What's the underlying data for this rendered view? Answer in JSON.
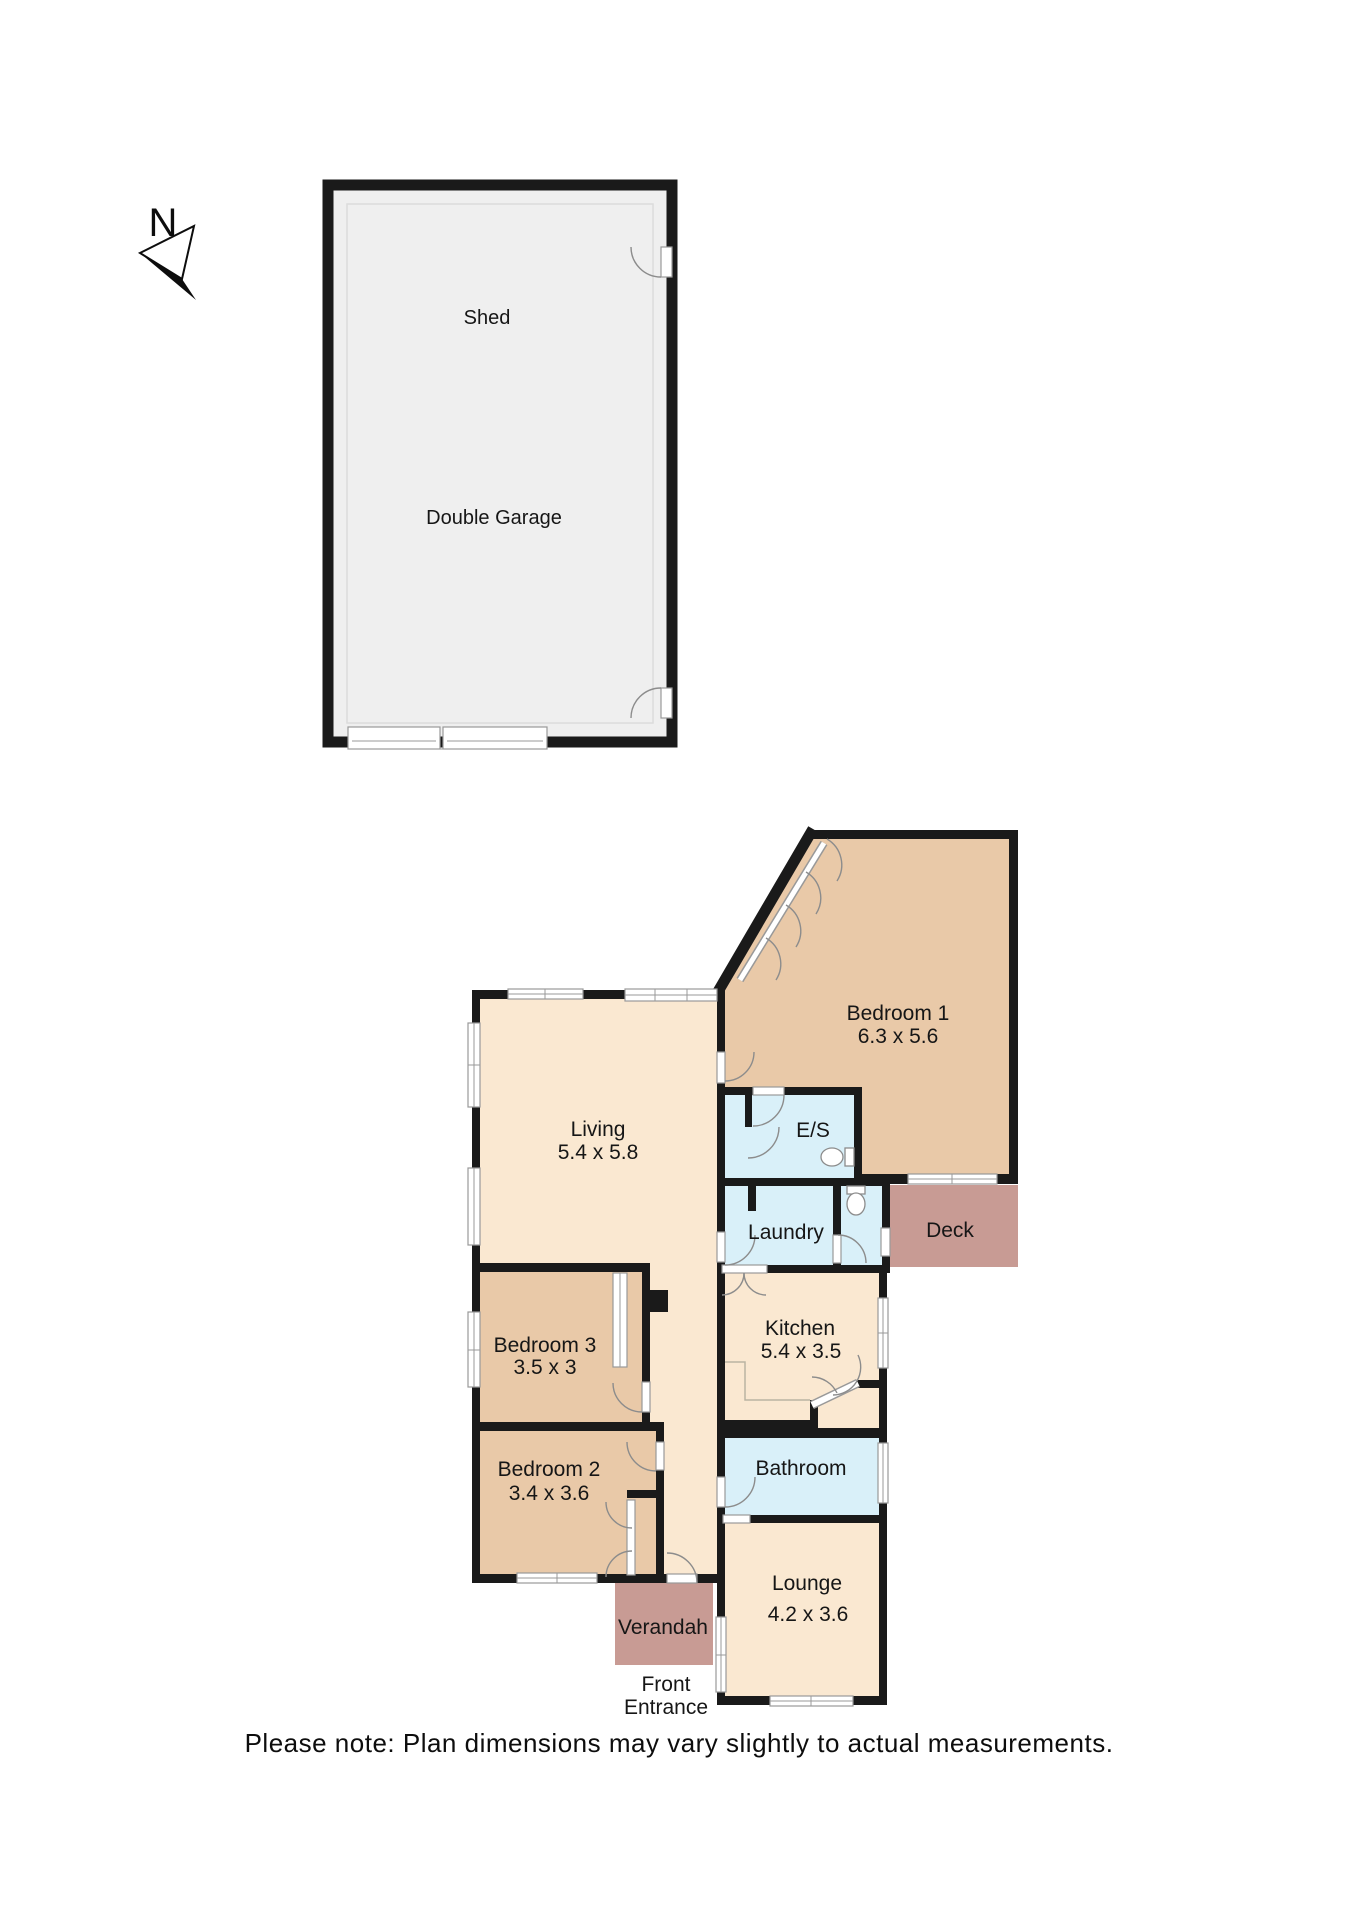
{
  "compass": {
    "label": "N"
  },
  "outbuilding": {
    "shed_label": "Shed",
    "garage_label": "Double Garage"
  },
  "rooms": {
    "living": {
      "name": "Living",
      "dims": "5.4 x 5.8"
    },
    "bedroom1": {
      "name": "Bedroom 1",
      "dims": "6.3 x 5.6"
    },
    "ensuite": {
      "name": "E/S"
    },
    "laundry": {
      "name": "Laundry"
    },
    "deck": {
      "name": "Deck"
    },
    "kitchen": {
      "name": "Kitchen",
      "dims": "5.4 x 3.5"
    },
    "bedroom3": {
      "name": "Bedroom 3",
      "dims": "3.5 x 3"
    },
    "bedroom2": {
      "name": "Bedroom 2",
      "dims": "3.4 x 3.6"
    },
    "bathroom": {
      "name": "Bathroom"
    },
    "lounge": {
      "name": "Lounge",
      "dims": "4.2 x 3.6"
    },
    "verandah": {
      "name": "Verandah"
    }
  },
  "entrance": {
    "line1": "Front",
    "line2": "Entrance"
  },
  "note": {
    "text": "Please note: Plan dimensions may vary slightly to actual measurements."
  },
  "colors": {
    "wall": "#1a1a1a",
    "cream": "#fae8d1",
    "bedroom": "#e9c9a8",
    "wet": "#d9f0f9",
    "deck": "#c89b94",
    "shed": "#efefef",
    "window_stroke": "#999999"
  }
}
